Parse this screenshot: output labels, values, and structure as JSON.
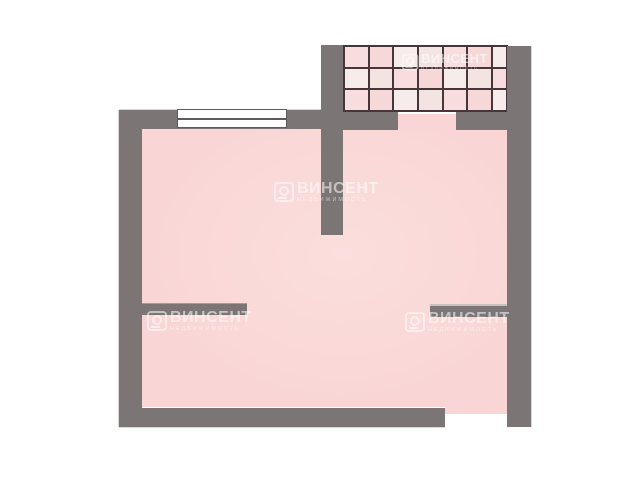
{
  "watermark": {
    "title": "ВИНСЕНТ",
    "subtitle": "НЕДВИЖИМОСТЬ",
    "instances": 4
  },
  "colors": {
    "wall": "#7c7575",
    "floor": "#f9d6d5",
    "floor_light": "#fbdedd",
    "tile_line": "#463639",
    "window_pane": "#fdfdfd",
    "watermark": "rgba(255,255,255,0.55)"
  },
  "balcony": {
    "rows": 3,
    "cols": 7,
    "tile_colors": [
      "#f7dddd",
      "#f3e4e2",
      "#f6ecea",
      "#f6d8d8"
    ]
  }
}
